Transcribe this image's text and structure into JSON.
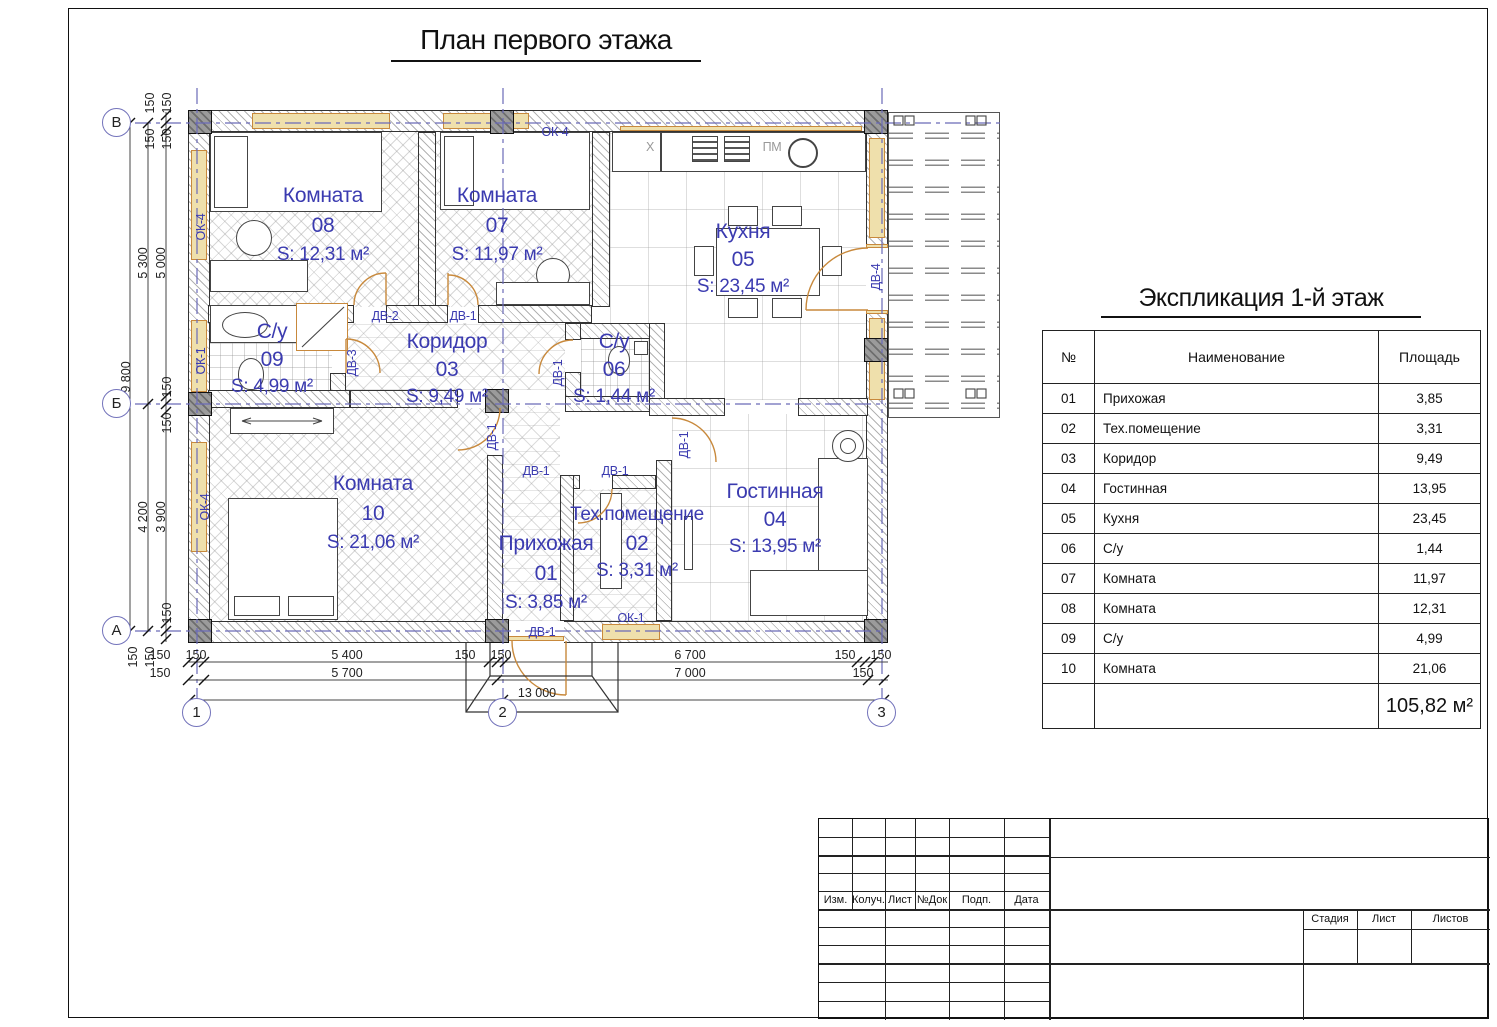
{
  "sheet": {
    "title": "План первого этажа"
  },
  "plan": {
    "rooms": {
      "r01": {
        "name": "Прихожая",
        "num": "01",
        "area": "S: 3,85 м²"
      },
      "r02": {
        "name": "Тех.помещение",
        "num": "02",
        "area": "S: 3,31 м²"
      },
      "r03": {
        "name": "Коридор",
        "num": "03",
        "area": "S: 9,49 м²"
      },
      "r04": {
        "name": "Гостинная",
        "num": "04",
        "area": "S: 13,95 м²"
      },
      "r05": {
        "name": "Кухня",
        "num": "05",
        "area": "S: 23,45 м²"
      },
      "r06": {
        "name": "С/у",
        "num": "06",
        "area": "S: 1,44 м²"
      },
      "r07": {
        "name": "Комната",
        "num": "07",
        "area": "S: 11,97 м²"
      },
      "r08": {
        "name": "Комната",
        "num": "08",
        "area": "S: 12,31 м²"
      },
      "r09": {
        "name": "С/у",
        "num": "09",
        "area": "S: 4,99 м²"
      },
      "r10": {
        "name": "Комната",
        "num": "10",
        "area": "S: 21,06 м²"
      }
    },
    "tags": {
      "dv1": "ДВ-1",
      "dv2": "ДВ-2",
      "dv3": "ДВ-3",
      "dv4": "ДВ-4",
      "ok1": "ОК-1",
      "ok4": "ОК-4",
      "pm": "ПМ",
      "x": "X"
    },
    "grid": {
      "letters": [
        "В",
        "Б",
        "А"
      ],
      "numbers": [
        "1",
        "2",
        "3"
      ]
    },
    "dims": {
      "d9800": "9 800",
      "d5300": "5 300",
      "d5000": "5 000",
      "d4200": "4 200",
      "d3900": "3 900",
      "d150": "150",
      "d5400": "5 400",
      "d5700": "5 700",
      "d6700": "6 700",
      "d7000": "7 000",
      "d13000": "13 000"
    }
  },
  "explication": {
    "title": "Экспликация 1-й этаж",
    "columns": [
      "№",
      "Наименование",
      "Площадь"
    ],
    "rows": [
      {
        "num": "01",
        "name": "Прихожая",
        "area": "3,85"
      },
      {
        "num": "02",
        "name": "Тех.помещение",
        "area": "3,31"
      },
      {
        "num": "03",
        "name": "Коридор",
        "area": "9,49"
      },
      {
        "num": "04",
        "name": "Гостинная",
        "area": "13,95"
      },
      {
        "num": "05",
        "name": "Кухня",
        "area": "23,45"
      },
      {
        "num": "06",
        "name": "С/у",
        "area": "1,44"
      },
      {
        "num": "07",
        "name": "Комната",
        "area": "11,97"
      },
      {
        "num": "08",
        "name": "Комната",
        "area": "12,31"
      },
      {
        "num": "09",
        "name": "С/у",
        "area": "4,99"
      },
      {
        "num": "10",
        "name": "Комната",
        "area": "21,06"
      }
    ],
    "total": "105,82 м²"
  },
  "titleblock": {
    "cols": [
      "Изм.",
      "Колуч.",
      "Лист",
      "№Док",
      "Подп.",
      "Дата"
    ],
    "stamp": [
      "Стадия",
      "Лист",
      "Листов"
    ]
  },
  "colors": {
    "accent_blue": "#3b3bb0",
    "axis_blue": "#6a6ab8",
    "door_tan": "#c8893c",
    "window_fill": "#efe0ac"
  }
}
